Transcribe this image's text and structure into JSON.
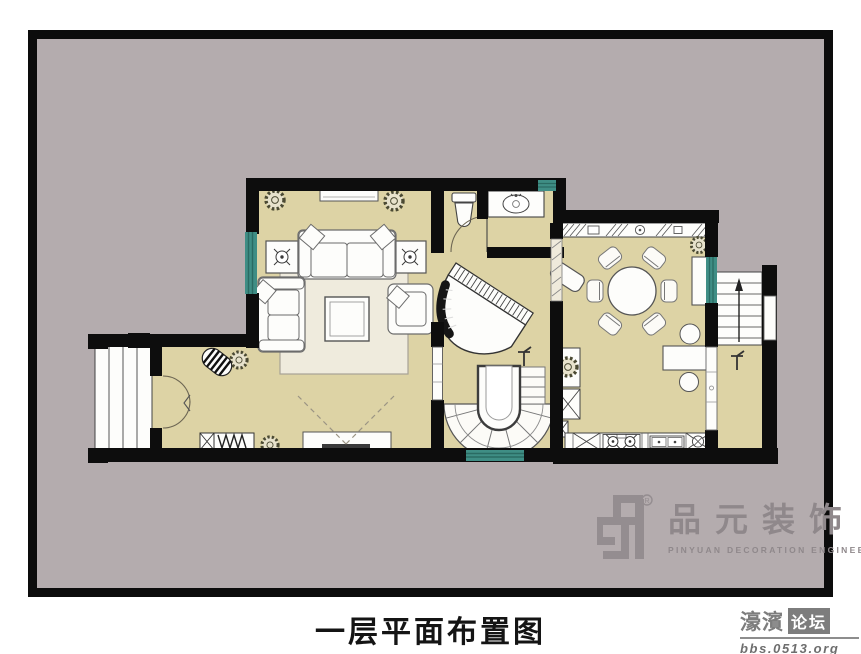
{
  "caption": {
    "text": "一层平面布置图"
  },
  "branding": {
    "mark": "zp",
    "registered": "®",
    "company_cn": "品元装饰",
    "company_en": "PINYUAN DECORATION ENGINEERING"
  },
  "watermark": {
    "site": "濠濱",
    "forum": "论坛",
    "url": "bbs.0513.org"
  },
  "colors": {
    "page_background": "#ffffff",
    "frame": "#0c0c0c",
    "matte": "#b4acae",
    "floor": "#ddd3a5",
    "wall": "#0d0d0d",
    "window_teal": "#3f8e85",
    "furniture_outline": "#6b6b6b",
    "logo_gray": "#8f888b",
    "watermark_gray": "#757575"
  },
  "floor_plan": {
    "rooms": [
      "living-room",
      "entry-hall",
      "bathroom",
      "piano-nook",
      "spiral-staircase",
      "dining-room",
      "kitchen",
      "rear-landing",
      "exterior-entry-steps",
      "exterior-rear-stairs"
    ],
    "symbols": [
      "sofa-set",
      "coffee-table",
      "side-table-lamp",
      "tv-cabinet",
      "rug",
      "grand-piano",
      "piano-bench",
      "round-dining-table",
      "dining-chair",
      "sideboard-counter",
      "kitchen-counter",
      "stove",
      "kitchen-sink",
      "toilet",
      "vanity-sink",
      "shoe-cabinet",
      "doormat",
      "potted-plant",
      "desk",
      "stool",
      "stair-direction-arrow",
      "level-marker",
      "window",
      "door-swing"
    ]
  }
}
